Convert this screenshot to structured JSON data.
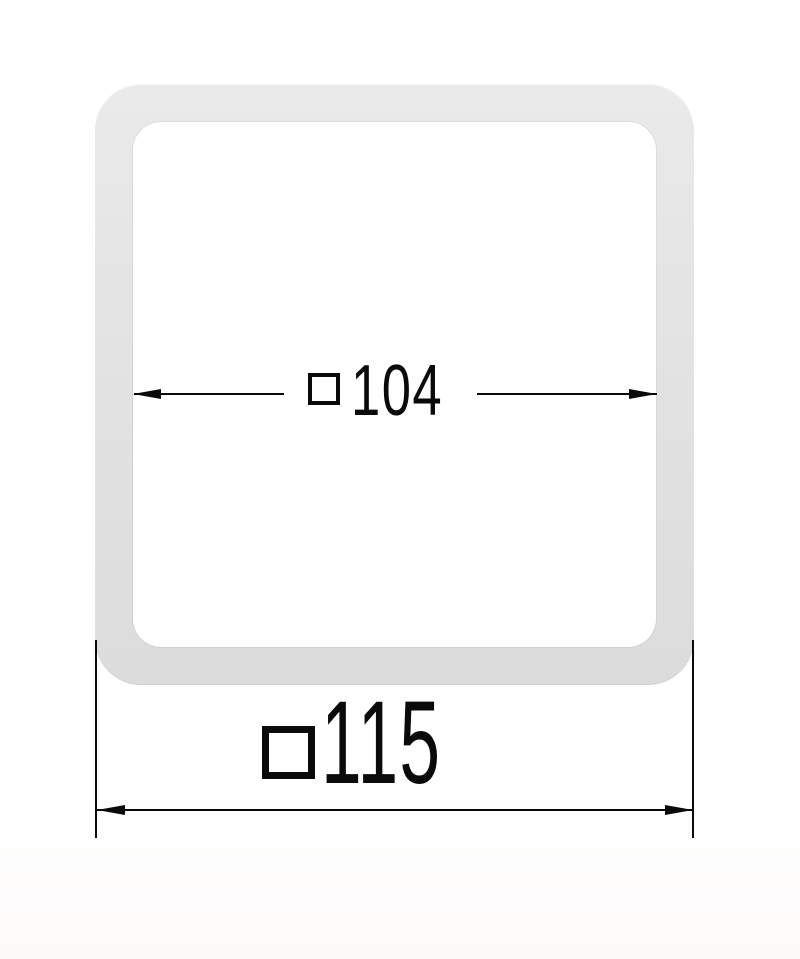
{
  "annotations": {
    "inner": {
      "symbol": "□",
      "value": "104"
    },
    "outer": {
      "symbol": "□",
      "value": "115"
    }
  },
  "colors": {
    "background": "#ffffff",
    "gasket_fill": "#e3e3e3",
    "gasket_fill_light": "#eaeaea",
    "gasket_fill_dark": "#dcdcdc",
    "line_color": "#0a0a0a"
  }
}
